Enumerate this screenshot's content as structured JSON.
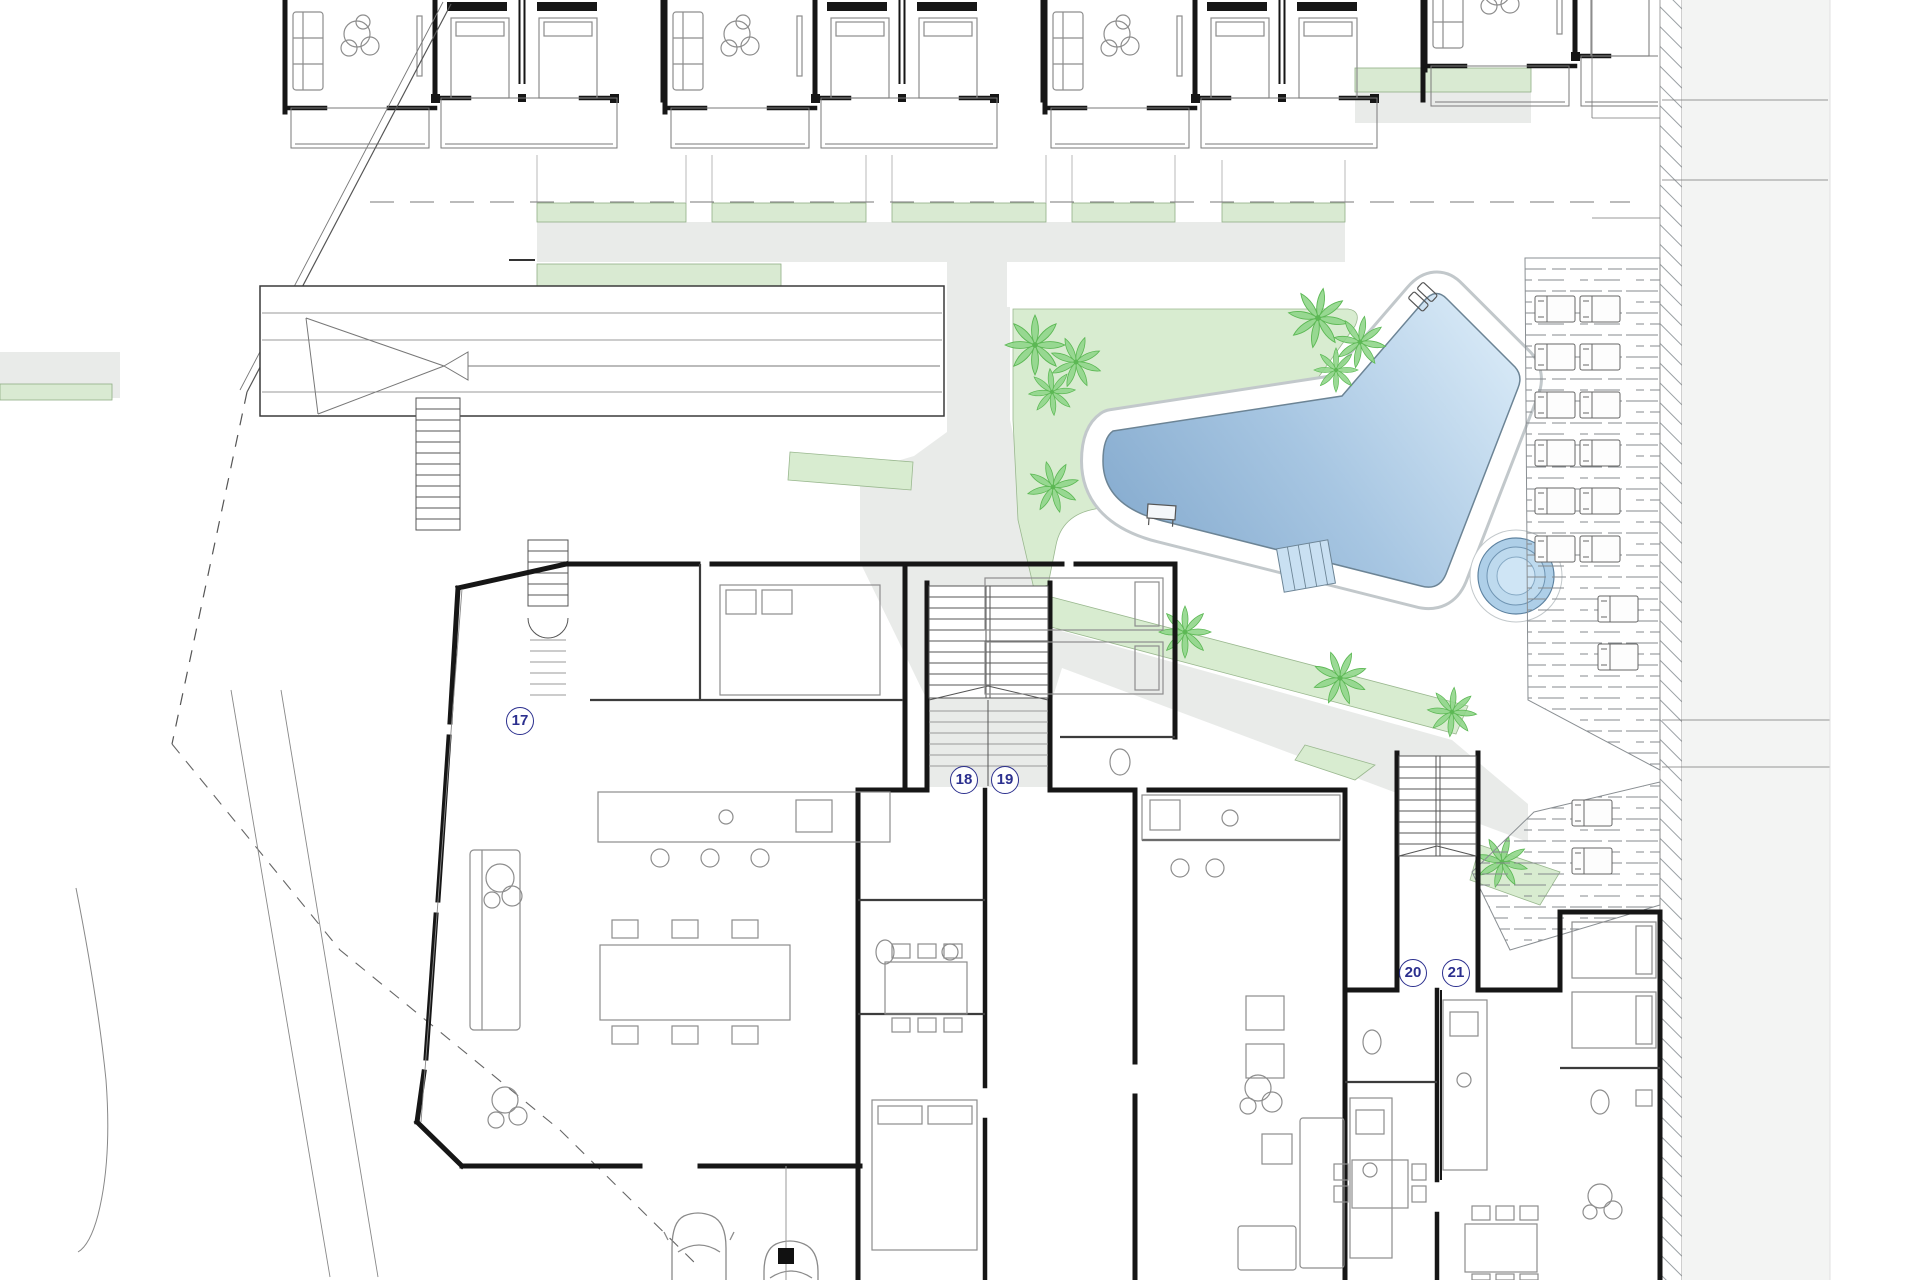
{
  "plan": {
    "units": [
      {
        "id": "unit-17",
        "label": "17"
      },
      {
        "id": "unit-18",
        "label": "18"
      },
      {
        "id": "unit-19",
        "label": "19"
      },
      {
        "id": "unit-20",
        "label": "20"
      },
      {
        "id": "unit-21",
        "label": "21"
      }
    ],
    "colors": {
      "lawn_green": "#d8ecd0",
      "terrace_green": "#d9ead2",
      "path_gray": "#e9ebe9",
      "road_gray": "#f3f4f3",
      "pool_dark_blue": "#83a9cd",
      "pool_light_blue": "#d6e8f6",
      "wall_black": "#161616",
      "label_blue": "#2b2f8e",
      "palm_green": "#90d689"
    }
  }
}
